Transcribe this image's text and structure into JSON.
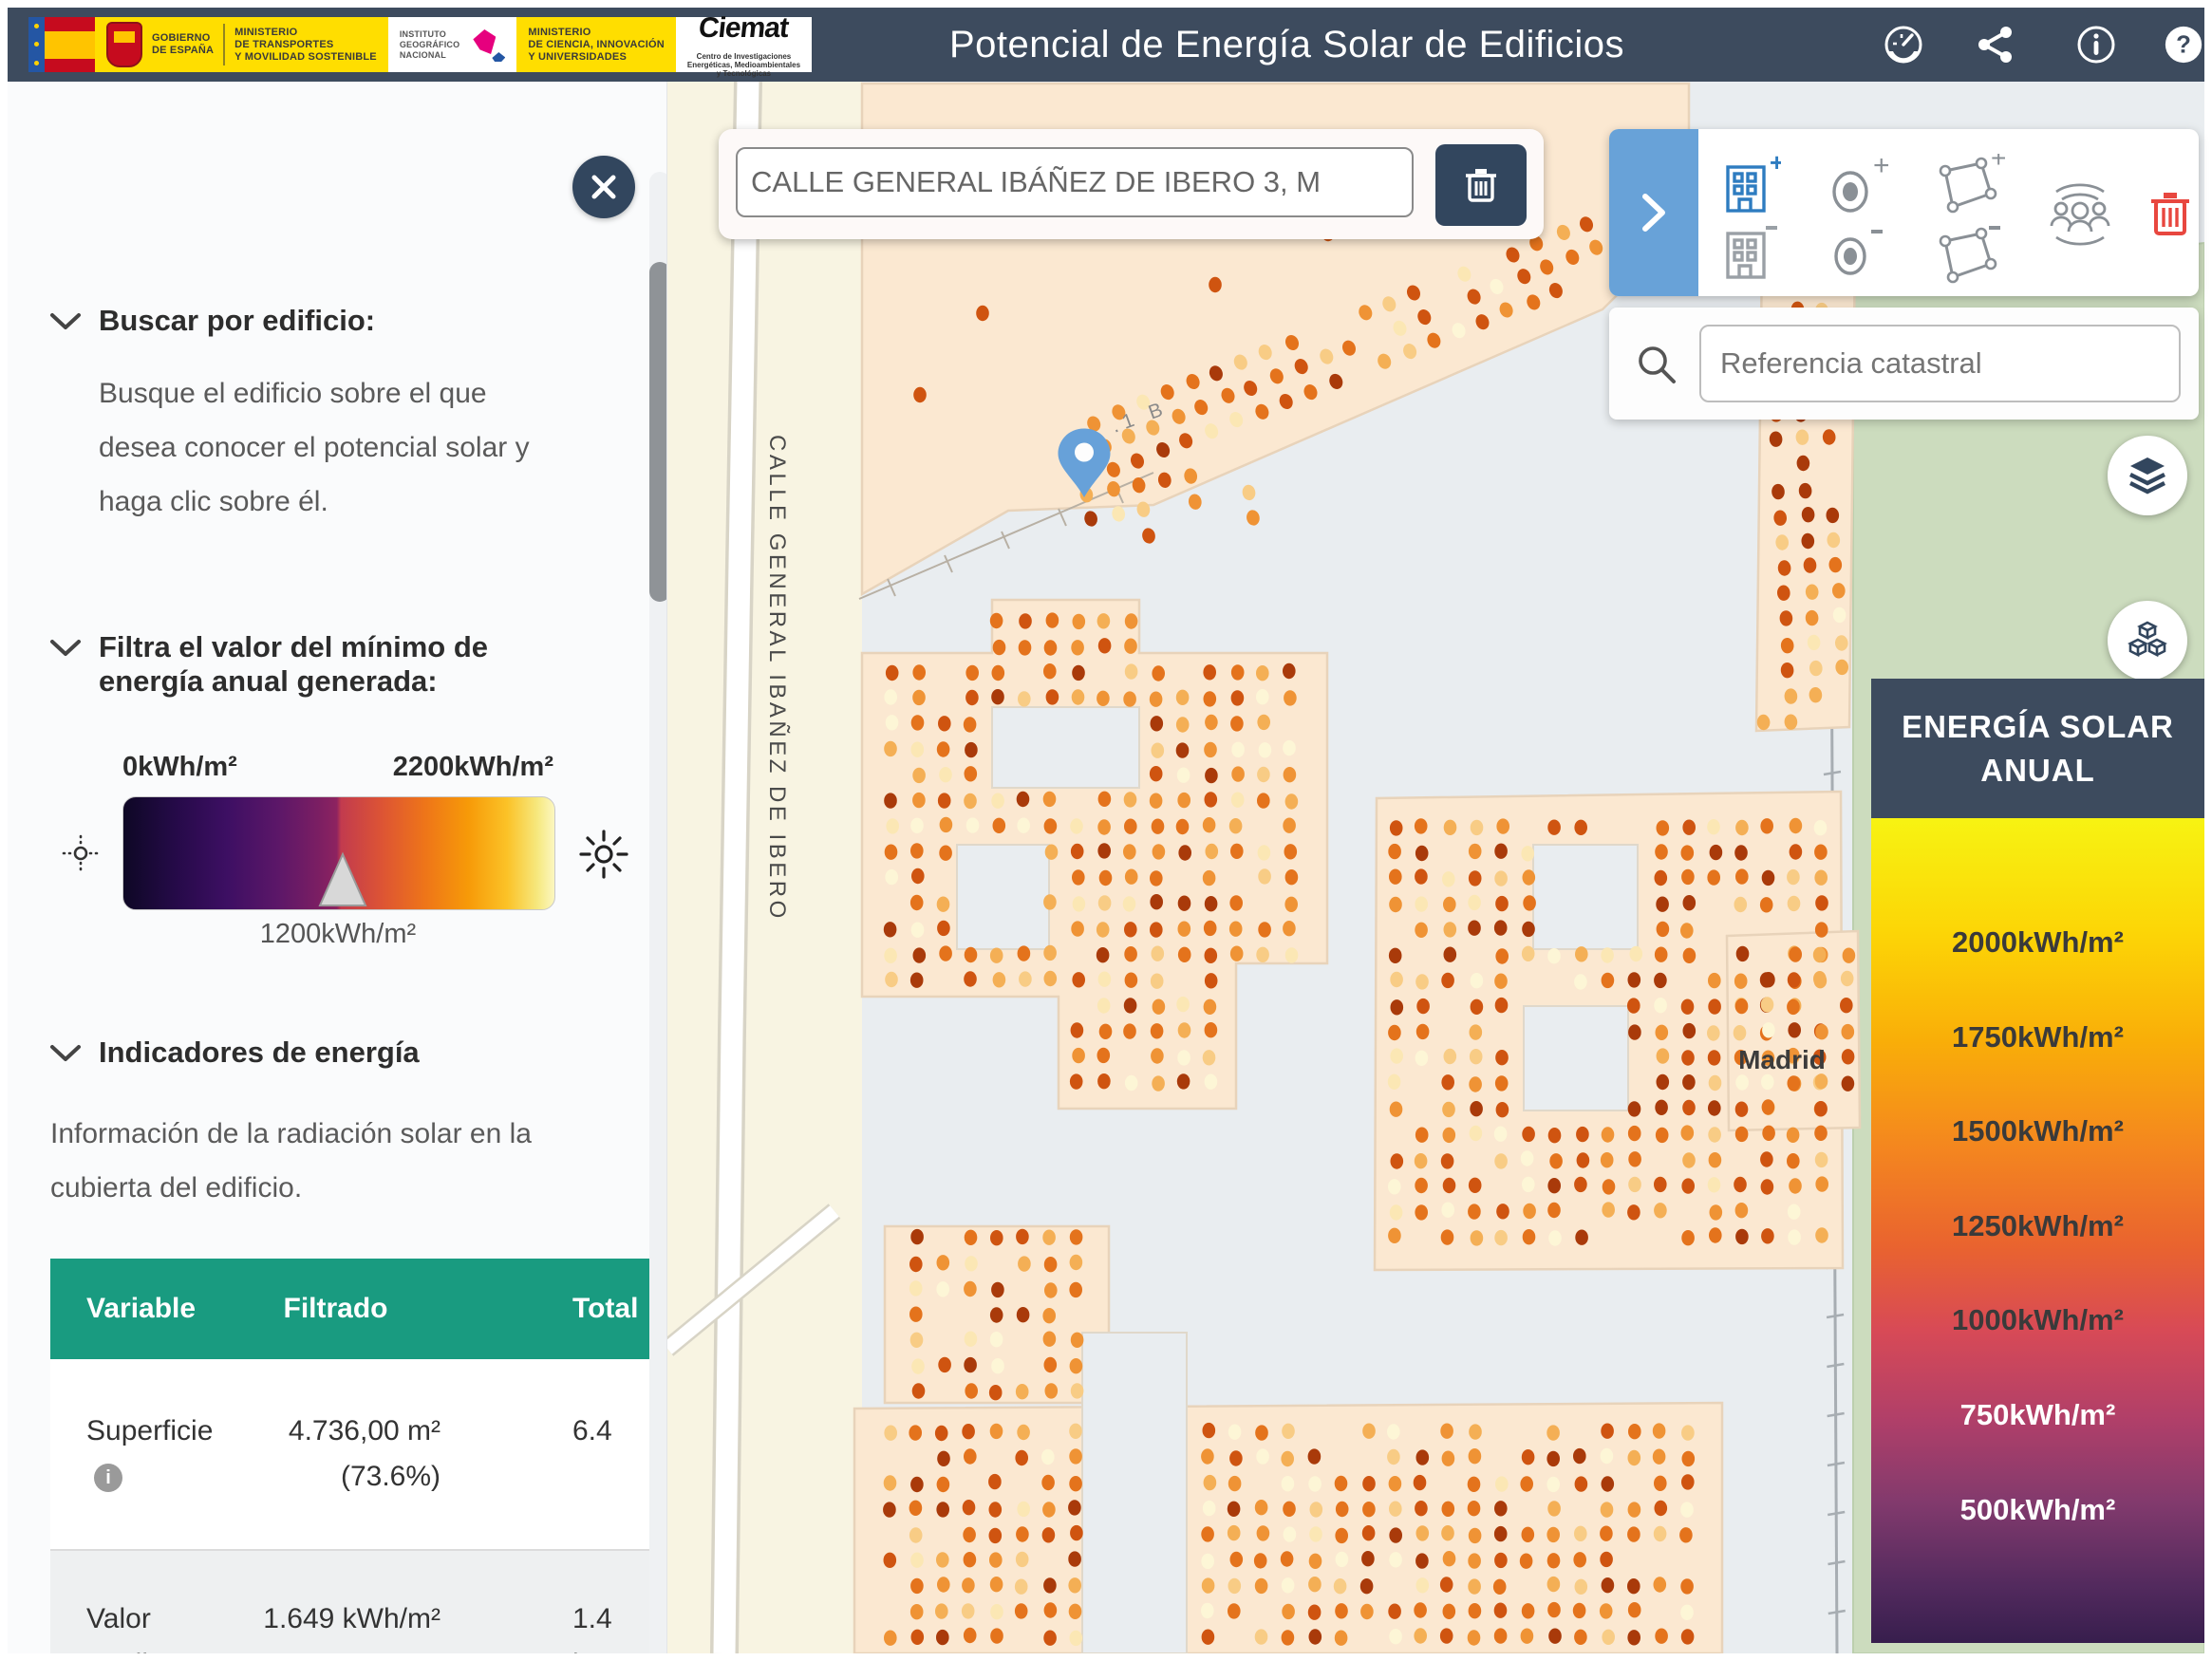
{
  "header": {
    "title": "Potencial de Energía Solar de Edificios",
    "logo": {
      "gobierno_l1": "GOBIERNO",
      "gobierno_l2": "DE ESPAÑA",
      "transportes_l1": "MINISTERIO",
      "transportes_l2": "DE TRANSPORTES",
      "transportes_l3": "Y MOVILIDAD SOSTENIBLE",
      "ign_l1": "INSTITUTO",
      "ign_l2": "GEOGRÁFICO",
      "ign_l3": "NACIONAL",
      "ciencia_l1": "MINISTERIO",
      "ciencia_l2": "DE CIENCIA, INNOVACIÓN",
      "ciencia_l3": "Y UNIVERSIDADES",
      "ciemat": "Ciemat",
      "ciemat_sub1": "Centro de Investigaciones",
      "ciemat_sub2": "Energéticas, Medioambientales",
      "ciemat_sub3": "y Tecnológicas"
    }
  },
  "sidebar": {
    "buscar": {
      "title": "Buscar por edificio:",
      "description": "Busque el edificio sobre el que desea conocer el potencial solar y haga clic sobre él."
    },
    "filtra": {
      "title_l1": "Filtra el valor del mínimo de",
      "title_l2": "energía anual generada:",
      "min": "0kWh/m²",
      "max": "2200kWh/m²",
      "current": "1200kWh/m²"
    },
    "indicadores": {
      "title": "Indicadores de energía",
      "description": "Información de la radiación solar en la cubierta del edificio.",
      "table": {
        "h_variable": "Variable",
        "h_filtrado": "Filtrado",
        "h_total": "Total",
        "r1_variable": "Superficie",
        "r1_filtrado": "4.736,00 m² (73.6%)",
        "r1_total": "6.4",
        "r2_variable": "Valor medio",
        "r2_filtrado": "1.649 kWh/m²",
        "r2_total_l1": "1.4",
        "r2_total_l2": "kW"
      }
    }
  },
  "map": {
    "search_value": "CALLE GENERAL IBÁÑEZ DE IBERO 3, M",
    "ref_placeholder": "Referencia catastral",
    "street_label": "CALLE GENERAL IBAÑEZ DE IBERO",
    "city_label": "Madrid",
    "parcel_label_1": ".1",
    "parcel_label_2": ".1 B",
    "palette": [
      "#a93a0a",
      "#cf5410",
      "#e4731c",
      "#ef9335",
      "#f4af55",
      "#f8cc85",
      "#fbe7b4",
      "#fdf6d6"
    ],
    "colors": {
      "building": "#fbe8d1",
      "building_edge": "#e8d3ba",
      "ground": "#e9edf0",
      "street_zone": "#f8f4e2",
      "park": "#ccdcbe",
      "pin": "#67a1d9",
      "accent_blue": "#68a2d8"
    }
  },
  "legend": {
    "title_l1": "ENERGÍA SOLAR",
    "title_l2": "ANUAL",
    "labels": [
      {
        "text": "2000kWh/m²",
        "light": false
      },
      {
        "text": "1750kWh/m²",
        "light": false
      },
      {
        "text": "1500kWh/m²",
        "light": false
      },
      {
        "text": "1250kWh/m²",
        "light": false
      },
      {
        "text": "1000kWh/m²",
        "light": false
      },
      {
        "text": "750kWh/m²",
        "light": true
      },
      {
        "text": "500kWh/m²",
        "light": true
      }
    ]
  }
}
